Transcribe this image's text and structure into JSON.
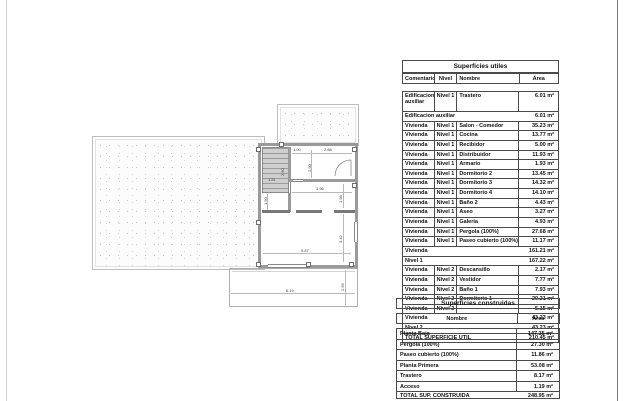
{
  "plan": {
    "dimension_labels": [
      {
        "text": "1.00",
        "x": 293,
        "y": 148,
        "vertical": false
      },
      {
        "text": "2.88",
        "x": 324,
        "y": 148,
        "vertical": false
      },
      {
        "text": "2.50",
        "x": 308,
        "y": 172,
        "vertical": true
      },
      {
        "text": "2.50",
        "x": 281,
        "y": 176,
        "vertical": true
      },
      {
        "text": "1.81",
        "x": 268,
        "y": 178,
        "vertical": false
      },
      {
        "text": "1.50",
        "x": 264,
        "y": 205,
        "vertical": true
      },
      {
        "text": "3.96",
        "x": 316,
        "y": 187,
        "vertical": false
      },
      {
        "text": "1.98",
        "x": 339,
        "y": 203,
        "vertical": true
      },
      {
        "text": "3.42",
        "x": 339,
        "y": 243,
        "vertical": true
      },
      {
        "text": "5.87",
        "x": 301,
        "y": 249,
        "vertical": false
      },
      {
        "text": "6.19",
        "x": 286,
        "y": 289,
        "vertical": false
      },
      {
        "text": "2.56",
        "x": 341,
        "y": 291,
        "vertical": true
      }
    ]
  },
  "tables": {
    "utiles": {
      "title": "Superficies utiles",
      "columns": {
        "comentarios": "Comentarios",
        "nivel": "Nivel",
        "nombre": "Nombre",
        "area": "Área"
      },
      "rows": [
        {
          "type": "data",
          "tall": true,
          "comentarios": "Edificacion auxiliar",
          "nivel": "Nivel 1",
          "nombre": "Trastero",
          "area": "6.01 m²"
        },
        {
          "type": "summary",
          "label": "Edificacion auxiliar",
          "area": "6.01 m²"
        },
        {
          "type": "data",
          "comentarios": "Vivienda",
          "nivel": "Nivel 1",
          "nombre": "Salon - Comedor",
          "area": "35.23 m²"
        },
        {
          "type": "data",
          "comentarios": "Vivienda",
          "nivel": "Nivel 1",
          "nombre": "Cocina",
          "area": "13.77 m²"
        },
        {
          "type": "data",
          "comentarios": "Vivienda",
          "nivel": "Nivel 1",
          "nombre": "Recibidor",
          "area": "5.00 m²"
        },
        {
          "type": "data",
          "comentarios": "Vivienda",
          "nivel": "Nivel 1",
          "nombre": "Distribuidor",
          "area": "11.93 m²"
        },
        {
          "type": "data",
          "comentarios": "Vivienda",
          "nivel": "Nivel 1",
          "nombre": "Armario",
          "area": "1.93 m²"
        },
        {
          "type": "data",
          "comentarios": "Vivienda",
          "nivel": "Nivel 1",
          "nombre": "Dormitorio 2",
          "area": "13.45 m²"
        },
        {
          "type": "data",
          "comentarios": "Vivienda",
          "nivel": "Nivel 1",
          "nombre": "Dormitorio 3",
          "area": "14.32 m²"
        },
        {
          "type": "data",
          "comentarios": "Vivienda",
          "nivel": "Nivel 1",
          "nombre": "Dormitorio 4",
          "area": "14.10 m²"
        },
        {
          "type": "data",
          "comentarios": "Vivienda",
          "nivel": "Nivel 1",
          "nombre": "Baño 2",
          "area": "4.43 m²"
        },
        {
          "type": "data",
          "comentarios": "Vivienda",
          "nivel": "Nivel 1",
          "nombre": "Aseo",
          "area": "3.27 m²"
        },
        {
          "type": "data",
          "comentarios": "Vivienda",
          "nivel": "Nivel 1",
          "nombre": "Galeria",
          "area": "4.93 m²"
        },
        {
          "type": "data",
          "comentarios": "Vivienda",
          "nivel": "Nivel 1",
          "nombre": "Pergola (100%)",
          "area": "27.68 m²"
        },
        {
          "type": "data",
          "comentarios": "Vivienda",
          "nivel": "Nivel 1",
          "nombre": "Paseo cubierto (100%)",
          "area": "11.17 m²"
        },
        {
          "type": "summary",
          "label": "Vivienda",
          "area": "161.21 m²"
        },
        {
          "type": "summary",
          "label": "Nivel 1",
          "area": "167.22 m²"
        },
        {
          "type": "data",
          "comentarios": "Vivienda",
          "nivel": "Nivel 2",
          "nombre": "Descansillo",
          "area": "2.17 m²"
        },
        {
          "type": "data",
          "comentarios": "Vivienda",
          "nivel": "Nivel 2",
          "nombre": "Vestidor",
          "area": "7.77 m²"
        },
        {
          "type": "data",
          "comentarios": "Vivienda",
          "nivel": "Nivel 2",
          "nombre": "Baño 1",
          "area": "7.93 m²"
        },
        {
          "type": "data",
          "comentarios": "Vivienda",
          "nivel": "Nivel 2",
          "nombre": "Dormitorio 1",
          "area": "20.21 m²"
        },
        {
          "type": "data",
          "comentarios": "Vivienda",
          "nivel": "Nivel 2",
          "nombre": "",
          "area": "5.15 m²"
        },
        {
          "type": "summary",
          "label": "Vivienda",
          "area": "43.23 m²"
        },
        {
          "type": "summary",
          "label": "Nivel 2",
          "area": "43.23 m²"
        },
        {
          "type": "total",
          "label": "TOTAL SUPERFICIE UTIL",
          "area": "210.45 m²"
        }
      ]
    },
    "construidas": {
      "title": "Superficies construidas",
      "columns": {
        "nombre": "Nombre",
        "area": "Área"
      },
      "rows": [
        {
          "nombre": "Planta Baja",
          "area": "147.35 m²"
        },
        {
          "nombre": "Pergola (100%)",
          "area": "27.30 m²"
        },
        {
          "nombre": "Paseo cubierto (100%)",
          "area": "11.86 m²"
        },
        {
          "nombre": "Planta Primera",
          "area": "53.08 m²"
        },
        {
          "nombre": "Trastero",
          "area": "8.17 m²"
        },
        {
          "nombre": "Acceso",
          "area": "1.19 m²"
        }
      ],
      "total": {
        "label": "TOTAL SUP. CONSTRUIDA",
        "area": "248.95 m²"
      }
    }
  }
}
